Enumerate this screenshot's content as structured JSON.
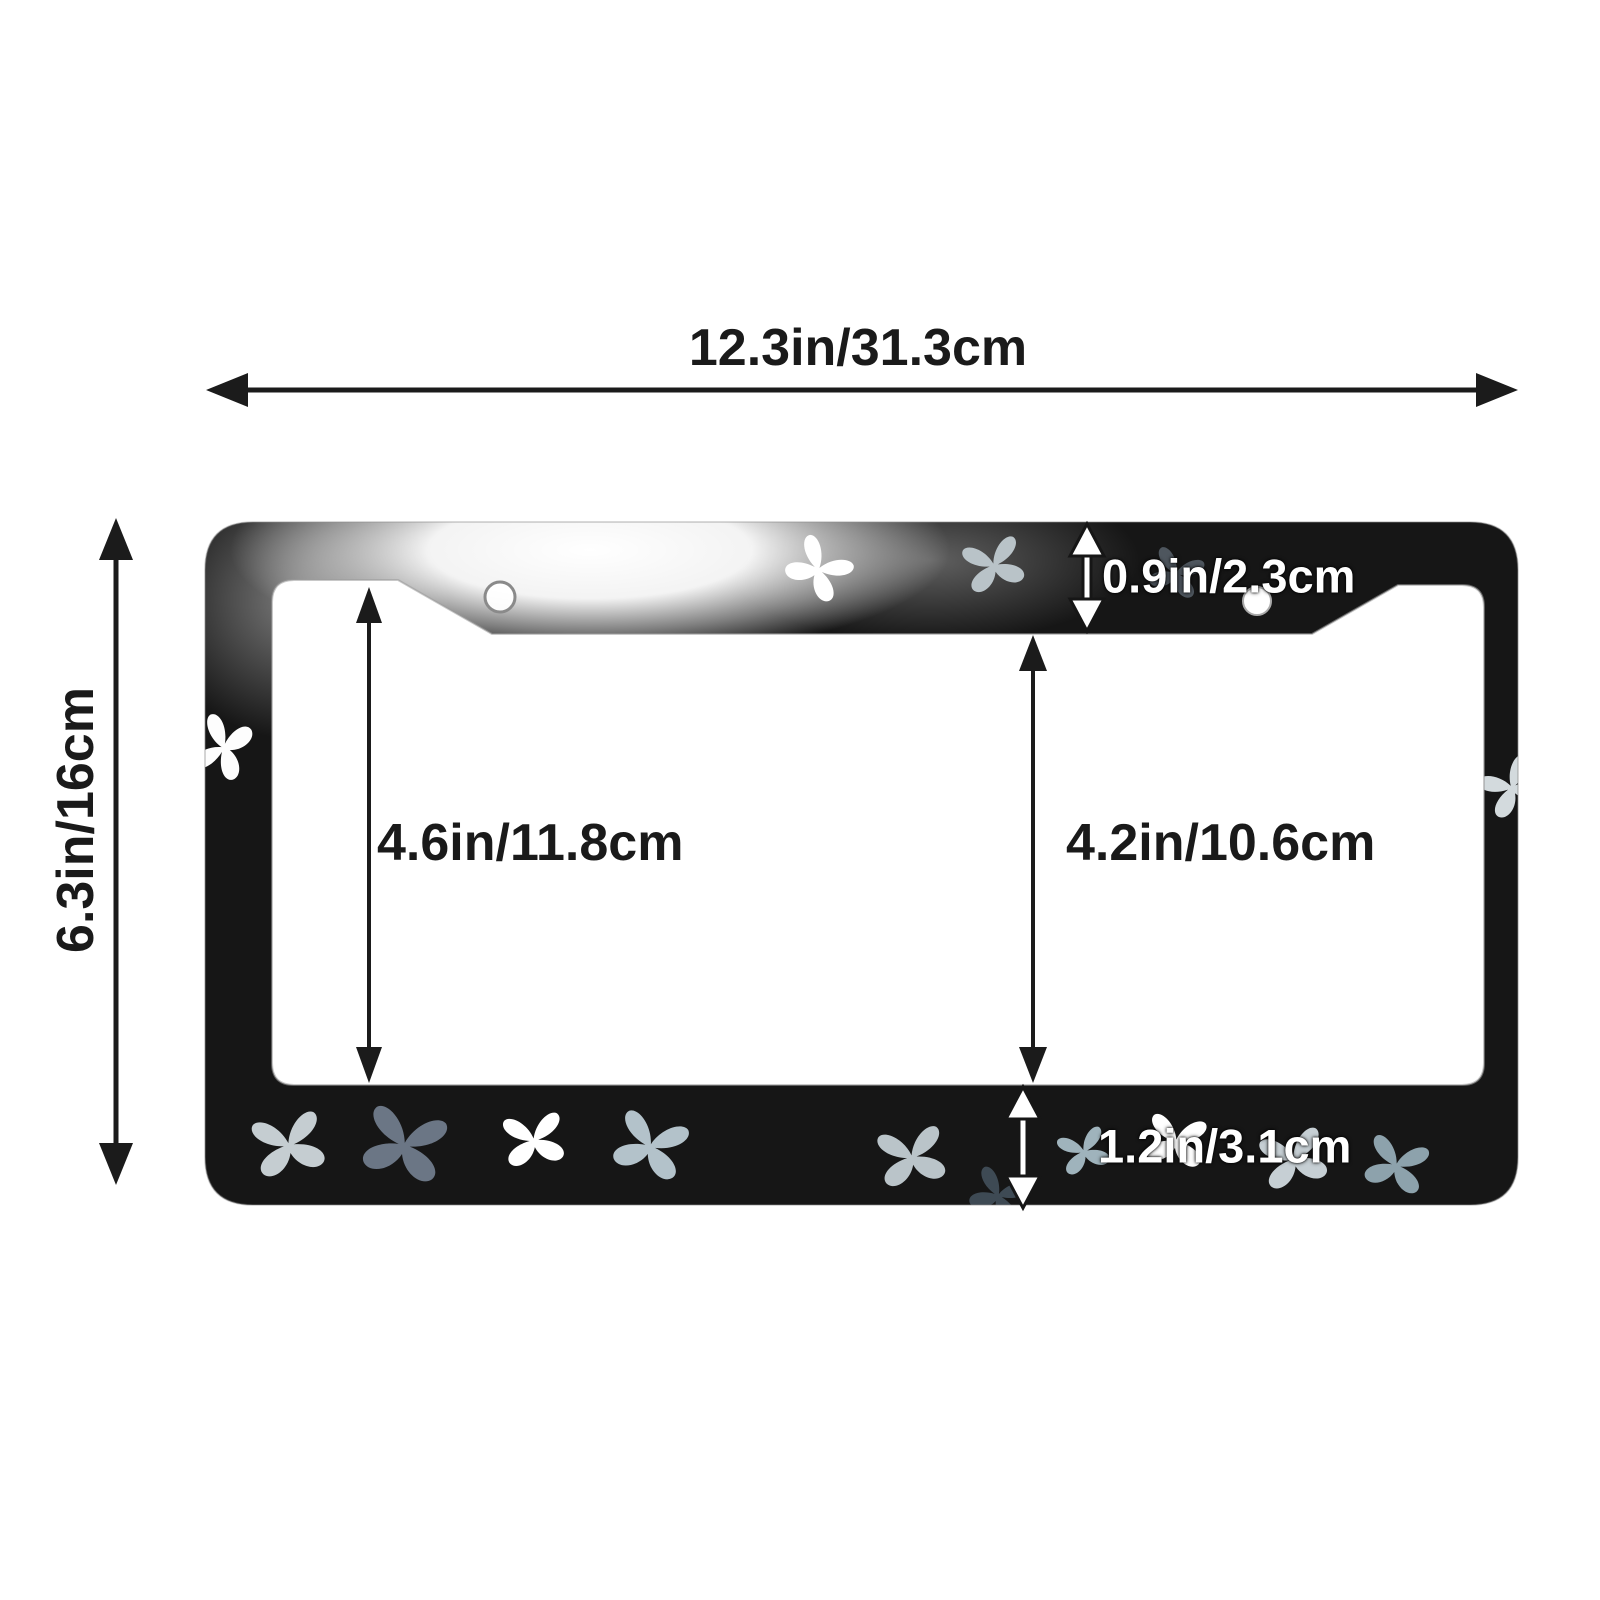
{
  "diagram": {
    "labels": {
      "overall_width": "12.3in/31.3cm",
      "overall_height": "6.3in/16cm",
      "opening_height_left": "4.6in/11.8cm",
      "opening_height_right": "4.2in/10.6cm",
      "top_bar_height": "0.9in/2.3cm",
      "bottom_bar_height": "1.2in/3.1cm"
    },
    "colors": {
      "frame": "#161616",
      "background": "#ffffff",
      "annotation_dark": "#1b1b1b",
      "annotation_light": "#ffffff",
      "butterfly_palette": [
        "#ffffff",
        "#c5cdd1",
        "#6b7685",
        "#b3c2ca",
        "#3e4a54",
        "#9fb3bc"
      ]
    }
  }
}
